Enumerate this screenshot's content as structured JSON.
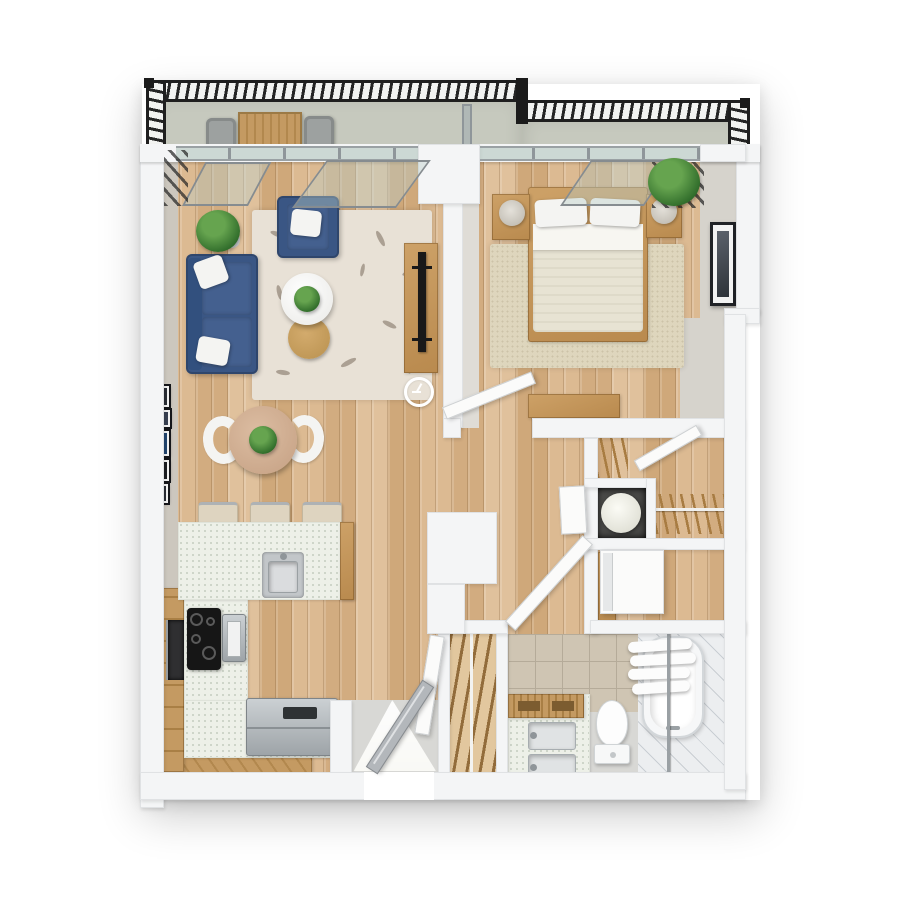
{
  "palette": {
    "page_bg": "#ffffff",
    "wall": "#f4f5f6",
    "wall_edge": "#e0e2e4",
    "wall_face": "#d6d3cc",
    "balcony_floor": "#c6c9be",
    "railing": "#242424",
    "glass": "#b1c4be",
    "sofa_blue": "#3a5684",
    "pillow_white": "#f4f4f2",
    "rug": "#e8e1d6",
    "rug_motif": "#97897c",
    "rug_bedroom": "#ded6bd",
    "wood_floor": "#d8b58b",
    "wood_furniture": "#cda167",
    "counter": "#edf0e8",
    "tile_beige": "#cfc5b3",
    "tile_line": "#b5ab99",
    "floor_pale": "#d8d8d5",
    "deck": "#eceef0",
    "door_white": "#fbfbfa",
    "door_gray": "#b3b7bb",
    "green_dark": "#2f6b2a",
    "green_light": "#66a44f",
    "black_appliance": "#161616",
    "nook_dark": "#4b4b49",
    "heater_white": "#f6f6f0"
  },
  "scene": {
    "type": "3d-floor-plan-top-view",
    "rooms": [
      {
        "name": "balcony",
        "furniture": [
          "metal-railing",
          "outdoor-table",
          "outdoor-chair-left",
          "outdoor-chair-right",
          "glass-divider",
          "potted-plant"
        ]
      },
      {
        "name": "living-room",
        "furniture": [
          "blue-sofa",
          "blue-armchair",
          "throw-pillows",
          "patterned-area-rug",
          "round-coffee-table",
          "nesting-side-table",
          "potted-plant",
          "tv-sideboard",
          "flat-tv",
          "wall-clock",
          "gallery-frames"
        ]
      },
      {
        "name": "dining-area",
        "furniture": [
          "round-dining-table",
          "white-chair-left",
          "white-chair-right",
          "centerpiece-plant"
        ]
      },
      {
        "name": "kitchen",
        "furniture": [
          "island-with-sink",
          "bar-stool-1",
          "bar-stool-2",
          "bar-stool-3",
          "cooktop",
          "built-in-oven",
          "microwave",
          "steel-appliance",
          "l-shaped-cabinets"
        ]
      },
      {
        "name": "bedroom",
        "furniture": [
          "double-bed",
          "pillows",
          "nightstand-left",
          "nightstand-right",
          "table-lamp-left",
          "table-lamp-right",
          "foot-bench",
          "area-rug",
          "wall-art",
          "potted-plant"
        ]
      },
      {
        "name": "closet-hall",
        "furniture": [
          "shelf-unit",
          "closet-door",
          "water-heater",
          "hanger-rod",
          "washer"
        ]
      },
      {
        "name": "bathroom",
        "furniture": [
          "double-sink-vanity",
          "wooden-tray",
          "toilet",
          "bathtub",
          "shower-curtain",
          "shower-rod"
        ]
      },
      {
        "name": "linen-closet",
        "furniture": [
          "slatted-shelves",
          "support-pole"
        ]
      },
      {
        "name": "entry",
        "furniture": [
          "front-door",
          "entry-pad",
          "daylight"
        ]
      }
    ]
  }
}
